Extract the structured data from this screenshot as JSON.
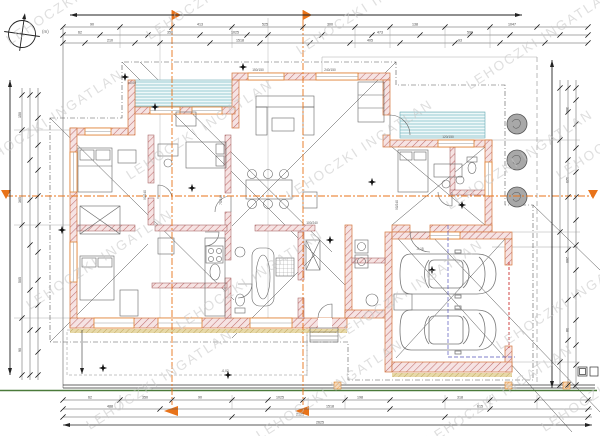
{
  "document": {
    "type": "architectural-floor-plan",
    "watermark": {
      "text": "LEHOCZKI INGATLAN",
      "color": "#c6c6c6"
    },
    "scale_note": "(m)"
  },
  "colors": {
    "wall_hatch": "#c07070",
    "wall_fill": "#f6e3e3",
    "exterior_trim_orange": "#d4763a",
    "interior_wall_edge": "#9a5252",
    "terrace_teal": "#74b9c2",
    "insulation_tan": "#b89c50",
    "section_marker_orange": "#e8731a",
    "boundary_green": "#4a7a3a",
    "garage_door_red": "#cc3333",
    "parking_guide_blue": "#5555bb",
    "tree_gray": "#a8a8a8",
    "dimension_line": "#555555"
  },
  "dims": {
    "top_b": [
      "90",
      "413",
      "525",
      "300",
      "138",
      "1047"
    ],
    "top_c": [
      "62",
      "350",
      "1025",
      "473",
      "590"
    ],
    "top_d": [
      "210",
      "1518",
      "405",
      "93"
    ],
    "left": [
      "150",
      "365",
      "505",
      "90"
    ],
    "right": [
      "300",
      "125",
      "260",
      "58"
    ],
    "bottom_a": [
      "62",
      "350",
      "90",
      "1025",
      "198",
      "318"
    ],
    "bottom_b": [
      "488",
      "1518",
      "615"
    ],
    "bottom_c": [
      "2121"
    ],
    "bottom_d": [
      "2625"
    ]
  },
  "labels": {
    "doors": [
      "90/240",
      "75/240",
      "100/240",
      "90/240"
    ],
    "windows": [
      "150/150",
      "240/150",
      "120/150"
    ],
    "elevations": [
      "±0,00",
      "-0,02",
      "-0,15"
    ]
  }
}
